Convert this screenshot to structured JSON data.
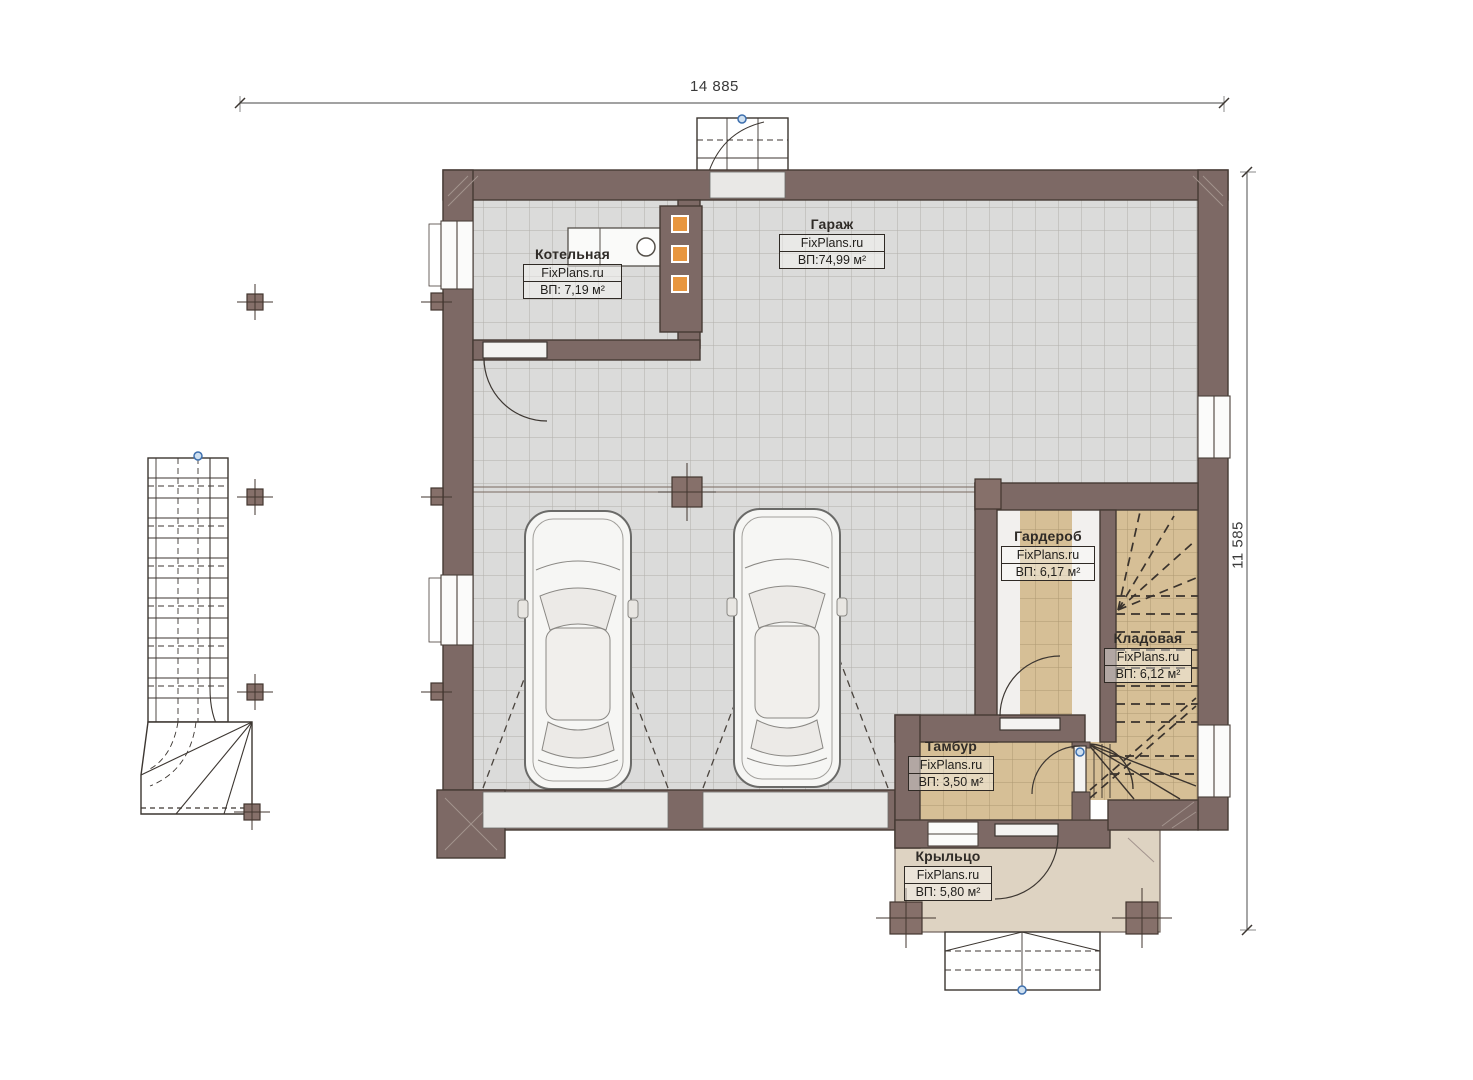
{
  "plan": {
    "type": "architectural-floor-plan",
    "site_brand": "FixPlans.ru",
    "dimensions": {
      "width_label": "14 885",
      "height_label": "11 585"
    },
    "rooms": [
      {
        "name": "Гараж",
        "brand": "FixPlans.ru",
        "area": "ВП:74,99 м²"
      },
      {
        "name": "Котельная",
        "brand": "FixPlans.ru",
        "area": "ВП: 7,19 м²"
      },
      {
        "name": "Гардероб",
        "brand": "FixPlans.ru",
        "area": "ВП: 6,17 м²"
      },
      {
        "name": "Кладовая",
        "brand": "FixPlans.ru",
        "area": "ВП: 6,12 м²"
      },
      {
        "name": "Тамбур",
        "brand": "FixPlans.ru",
        "area": "ВП: 3,50 м²"
      },
      {
        "name": "Крыльцо",
        "brand": "FixPlans.ru",
        "area": "ВП: 5,80 м²"
      }
    ],
    "colors": {
      "wall": "#7d6965",
      "floor_tile_gray": "#dbdbda",
      "floor_tile_tan": "#d6bf96",
      "porch_floor": "#ded3c2",
      "chimney_flue_orange": "#e8963f",
      "marker_blue": "#3d6fae"
    }
  }
}
